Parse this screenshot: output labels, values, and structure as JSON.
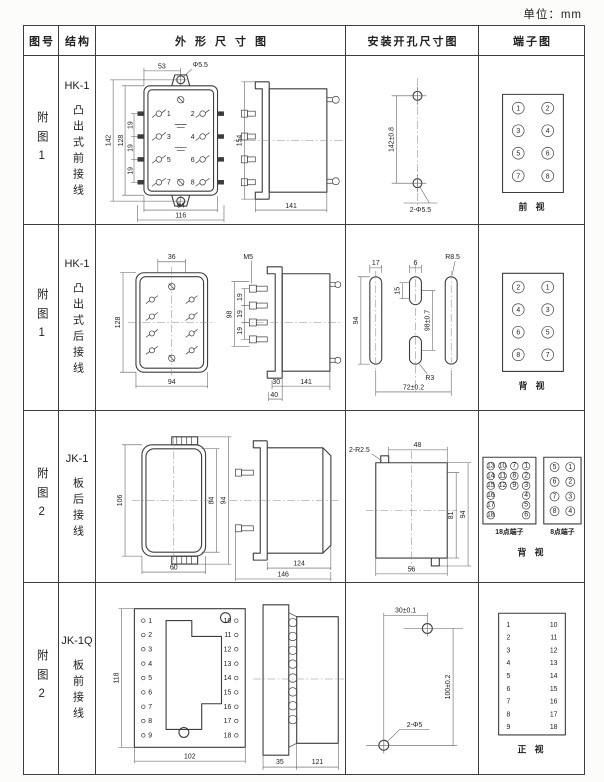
{
  "unit_label": "单位：mm",
  "headers": {
    "fig": "图号",
    "structure": "结构",
    "outline": "外形尺寸图",
    "mounting": "安装开孔尺寸图",
    "terminal": "端子图"
  },
  "rows": [
    {
      "fig": "附图1",
      "model": "HK-1",
      "structure": "凸出式前接线",
      "outline": {
        "top_width": "53",
        "hole": "Φ5.5",
        "height_outer": "142",
        "height_inner": "128",
        "pitch": "19",
        "bottom_inner": "94",
        "bottom_outer": "116",
        "side_height": "154",
        "side_depth": "141",
        "terminals": [
          "1",
          "2",
          "3",
          "4",
          "5",
          "6",
          "7",
          "8"
        ]
      },
      "mounting": {
        "vertical": "142±0.8",
        "holes": "2-Φ5.5"
      },
      "terminal": {
        "left": [
          "1",
          "3",
          "5",
          "7"
        ],
        "right": [
          "2",
          "4",
          "6",
          "8"
        ],
        "caption": "前 视"
      }
    },
    {
      "fig": "附图1",
      "model": "HK-1",
      "structure": "凸出式后接线",
      "outline": {
        "top_width": "36",
        "height": "128",
        "bottom_width": "94",
        "thread": "M5",
        "stud_span": "98",
        "pitch": "19",
        "depth_inner": "30",
        "depth_outer": "40",
        "side_depth": "141"
      },
      "mounting": {
        "slot_width": "17",
        "mid_slot_width": "6",
        "corner_radius": "R8.5",
        "mid_slot_height": "15",
        "slot_height": "94",
        "vertical": "98±0.7",
        "small_radius": "R3",
        "horizontal": "72±0.2"
      },
      "terminal": {
        "left": [
          "2",
          "4",
          "6",
          "8"
        ],
        "right": [
          "1",
          "3",
          "5",
          "7"
        ],
        "caption": "背 视"
      }
    },
    {
      "fig": "附图2",
      "model": "JK-1",
      "structure": "板后接线",
      "outline": {
        "height_outer": "106",
        "height_inner": "84",
        "height_mid": "94",
        "width": "60",
        "depth_inner": "124",
        "depth_outer": "146"
      },
      "mounting": {
        "corner_radius": "2-R2.5",
        "top_width": "48",
        "right_inner": "81",
        "right_outer": "94",
        "bottom_width": "56"
      },
      "terminal": {
        "cols18": [
          [
            "13",
            "14",
            "15",
            "16",
            "17",
            "18"
          ],
          [
            "10",
            "11",
            "12"
          ],
          [
            "7",
            "8",
            "9"
          ],
          [
            "1",
            "2",
            "3",
            "4",
            "5",
            "6"
          ]
        ],
        "label18": "18点端子",
        "cols8": [
          [
            "5",
            "6",
            "7",
            "8"
          ],
          [
            "1",
            "2",
            "3",
            "4"
          ]
        ],
        "label8": "8点端子",
        "caption": "背 视"
      }
    },
    {
      "fig": "附图2",
      "model": "JK-1Q",
      "structure": "板前接线",
      "outline": {
        "height": "118",
        "width": "102",
        "left_terminals": [
          "1",
          "2",
          "3",
          "4",
          "5",
          "6",
          "7",
          "8",
          "9"
        ],
        "right_terminals": [
          "10",
          "11",
          "12",
          "13",
          "14",
          "15",
          "16",
          "17",
          "18"
        ],
        "flange_depth": "35",
        "body_depth": "121"
      },
      "mounting": {
        "top": "30±0.1",
        "vertical": "100±0.2",
        "holes": "2-Φ5"
      },
      "terminal": {
        "left": [
          "1",
          "2",
          "3",
          "4",
          "5",
          "6",
          "7",
          "8",
          "9"
        ],
        "right": [
          "10",
          "11",
          "12",
          "13",
          "14",
          "15",
          "16",
          "17",
          "18"
        ],
        "caption": "正 视"
      }
    }
  ]
}
